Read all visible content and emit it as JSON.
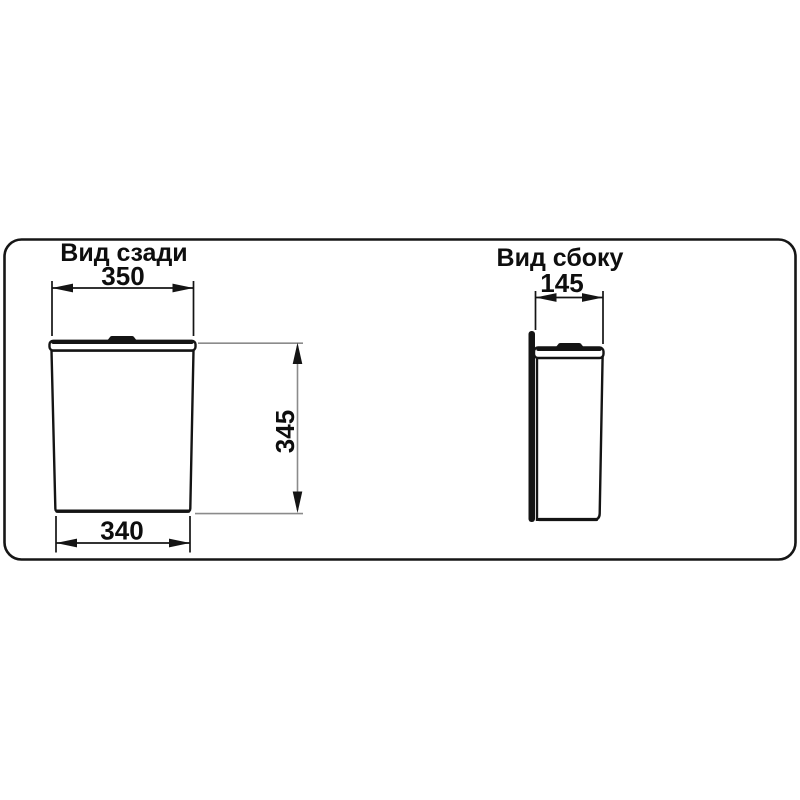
{
  "colors": {
    "line": "#141414",
    "dim": "#8b8b8b",
    "text": "#0e0e0e",
    "panel_border": "#161616",
    "background": "#ffffff"
  },
  "rear_view": {
    "title": "Вид сзади",
    "top_width": "350",
    "bottom_width": "340",
    "height": "345"
  },
  "side_view": {
    "title": "Вид сбоку",
    "depth": "145"
  }
}
